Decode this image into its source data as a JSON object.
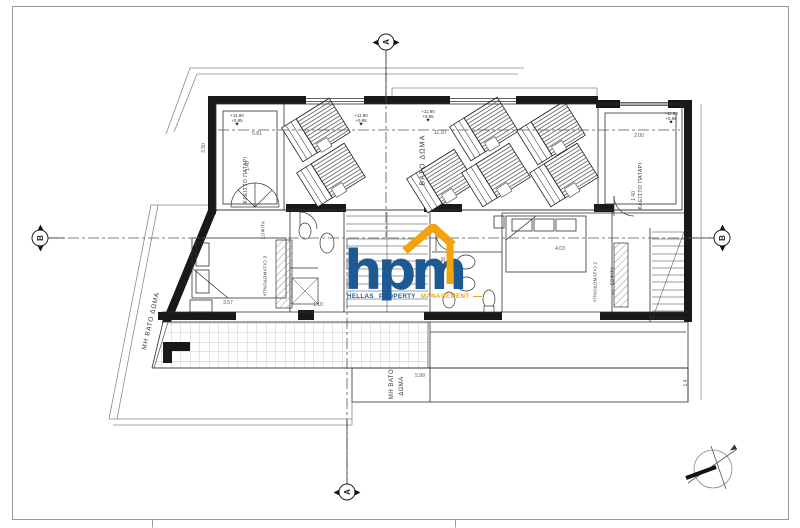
{
  "logo": {
    "monogram": "hpm",
    "words": [
      "HELLAS",
      "PROPERTY",
      "MANAGEMENT"
    ],
    "colors": {
      "blue": "#1d5a94",
      "orange": "#f2a30d"
    }
  },
  "section_markers": [
    {
      "id": "section-marker-top",
      "letter": "Α",
      "x": 386,
      "y": 42,
      "tri": "h"
    },
    {
      "id": "section-marker-bottom",
      "letter": "Α",
      "x": 347,
      "y": 492,
      "tri": "h"
    },
    {
      "id": "section-marker-left",
      "letter": "Β",
      "x": 40,
      "y": 238,
      "tri": "v"
    },
    {
      "id": "section-marker-right",
      "letter": "Β",
      "x": 722,
      "y": 238,
      "tri": "v"
    }
  ],
  "room_labels": [
    {
      "id": "label-vato-doma",
      "text": "ΒΑΤΟ ΔΩΜΑ",
      "x": 423,
      "y": 160,
      "rot": -90,
      "size": 7,
      "ls": 1.2
    },
    {
      "id": "label-kleisto-patari-left",
      "text": "ΚΛΕΙΣΤΟ ΠΑΤΑΡΙ",
      "x": 246,
      "y": 180,
      "rot": -90,
      "size": 5,
      "ls": 0.5
    },
    {
      "id": "label-kleisto-patari-right",
      "text": "ΚΛΕΙΣΤΟ ΠΑΤΑΡΙ",
      "x": 641,
      "y": 186,
      "rot": -90,
      "size": 5,
      "ls": 0.5
    },
    {
      "id": "label-mi-vato-doma-left",
      "text": "ΜΗ ΒΑΤΟ ΔΩΜΑ",
      "x": 151,
      "y": 321,
      "rot": -77,
      "size": 6.5,
      "ls": 0.8
    },
    {
      "id": "label-mi-vato-doma-line1",
      "text": "ΜΗ ΒΑΤΟ",
      "x": 392,
      "y": 384,
      "rot": -90,
      "size": 6,
      "ls": 0.5
    },
    {
      "id": "label-mi-vato-doma-line2",
      "text": "ΔΩΜΑ",
      "x": 402,
      "y": 386,
      "rot": -90,
      "size": 6,
      "ls": 0.5
    },
    {
      "id": "label-sofita-left",
      "text": "ΣΟΦΙΤΑ",
      "x": 263,
      "y": 230,
      "rot": -90,
      "size": 4.5,
      "ls": 0.3
    },
    {
      "id": "label-ypnodomatio-3",
      "text": "ΥΠΝΟΔΩΜΑΤΙΟ 3",
      "x": 265,
      "y": 276,
      "rot": -90,
      "size": 4.5,
      "ls": 0.3
    },
    {
      "id": "label-sofita-right",
      "text": "ΣΟΦΙΤΑ",
      "x": 612,
      "y": 276,
      "rot": -90,
      "size": 4.5,
      "ls": 0.3
    },
    {
      "id": "label-unit-a1",
      "text": "Α1",
      "x": 613,
      "y": 292,
      "rot": -90,
      "size": 4.5,
      "ls": 0.3
    },
    {
      "id": "label-ypnodomatio-2",
      "text": "ΥΠΝΟΔΩΜΑΤΙΟ 2",
      "x": 595,
      "y": 282,
      "rot": -90,
      "size": 4.5,
      "ls": 0.3
    }
  ],
  "dimension_labels": [
    {
      "text": "5.81",
      "x": 257,
      "y": 134,
      "rot": 0
    },
    {
      "text": "1.40",
      "x": 248,
      "y": 166,
      "rot": -90
    },
    {
      "text": "11.20",
      "x": 440,
      "y": 133,
      "rot": 0
    },
    {
      "text": "2.00",
      "x": 639,
      "y": 136,
      "rot": 0
    },
    {
      "text": "1.40",
      "x": 634,
      "y": 196,
      "rot": -90
    },
    {
      "text": "3.90",
      "x": 204,
      "y": 148,
      "rot": -90
    },
    {
      "text": "3.57",
      "x": 228,
      "y": 303,
      "rot": 0
    },
    {
      "text": "1.10",
      "x": 318,
      "y": 305,
      "rot": 0
    },
    {
      "text": "4.03",
      "x": 560,
      "y": 249,
      "rot": 0
    },
    {
      "text": "2.38",
      "x": 444,
      "y": 262,
      "rot": -90
    },
    {
      "text": "5.99",
      "x": 420,
      "y": 376,
      "rot": 0
    },
    {
      "text": "1.4",
      "x": 686,
      "y": 383,
      "rot": -90
    }
  ],
  "elevation_markers": [
    {
      "x": 237,
      "y": 121,
      "lines": [
        "+11.80",
        "+0.95"
      ]
    },
    {
      "x": 361,
      "y": 121,
      "lines": [
        "+11.80",
        "+0.95"
      ]
    },
    {
      "x": 428,
      "y": 117,
      "lines": [
        "+11.80",
        "+0.95"
      ]
    },
    {
      "x": 671,
      "y": 119,
      "lines": [
        "+11.80",
        "+0.95"
      ]
    }
  ]
}
